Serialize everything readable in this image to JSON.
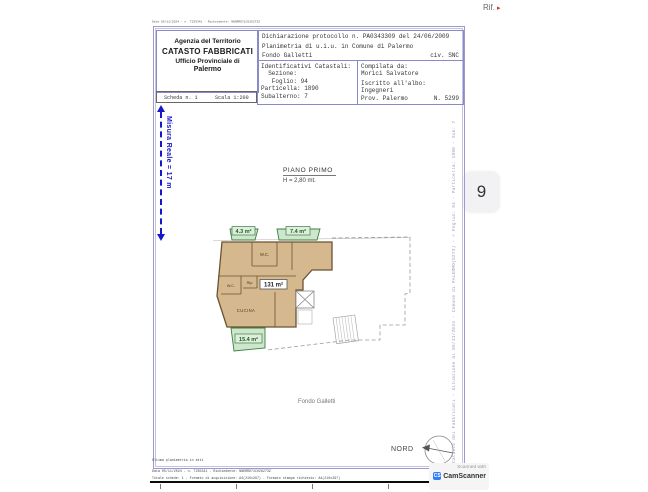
{
  "viewer": {
    "rif_label": "Rif.",
    "rif_arrow": "▸",
    "page_badge": "9",
    "scanner": {
      "line1": "Scanned with",
      "brand": "CamScanner",
      "logo": "CS"
    }
  },
  "page": {
    "top_meta": "Data 05/11/2024 - n. T235341 - Richiedente: NNDRRD71C02G273Z",
    "header": {
      "office_lines": [
        "Agenzia del Territorio",
        "CATASTO FABBRICATI",
        "Ufficio Provinciale di",
        "Palermo"
      ],
      "scheda": "Scheda n. 1",
      "scala": "Scala 1:200",
      "dichiarazione": "Dichiarazione protocollo n. PA0343309 del 24/06/2009",
      "planimetria": "Planimetria di u.i.u. in Comune di Palermo",
      "indirizzo": "Fondo Galletti",
      "civico": "civ. SNC",
      "catastali": {
        "title": "Identificativi Catastali:",
        "sezione": "  Sezione:",
        "foglio": "   Foglio: 94",
        "particella": "Particella: 1890",
        "subalterno": "Subalterno: 7"
      },
      "compilata": {
        "title": "Compilata da:",
        "nome": "Morici Salvatore",
        "albo_title": "Iscritto all'albo:",
        "albo": "Ingegneri",
        "prov": "Prov. Palermo",
        "numero": "N. 5299"
      }
    },
    "measure_label": "Misura Reale = 17 m",
    "plan": {
      "floor_title": "PIANO PRIMO",
      "floor_height": "H = 2,80 mt.",
      "balcony1_area": "4.3 m²",
      "balcony2_area": "7.4 m²",
      "main_area": "131 m²",
      "terrace_area": "15.4 m²",
      "wc1": "W.C.",
      "wc2": "W.C.",
      "rip": "Rip.",
      "cucina": "CUCINA",
      "street": "Fondo Galletti",
      "north": "NORD"
    },
    "side_note": "Catasto dei Fabbricati - Situazione al 05/11/2024 - Comune di PALERMO(G273) - < Foglio: 94 - Particella: 1890 - Sub: 7 > - FONDO GALLETTI - Interno 1 Piano 1",
    "footer": {
      "line1": "Ultima planimetria in atti",
      "line2": "Data 05/11/2024 - n. T235341 - Richiedente: NNDRRD71C02G273Z",
      "line3": "Totale schede: 1 - Formato di acquisizione: A4(210x297) - Formato stampa richiesto: A4(210x297)"
    },
    "colors": {
      "frame_blue": "#9a9ad0",
      "measure_blue": "#1717c9",
      "tan_fill": "#d6b88e",
      "wall_brown": "#6b5233",
      "green_fill": "#cde7cc",
      "green_border": "#3f7d42",
      "green_text": "#1e5c24"
    }
  }
}
